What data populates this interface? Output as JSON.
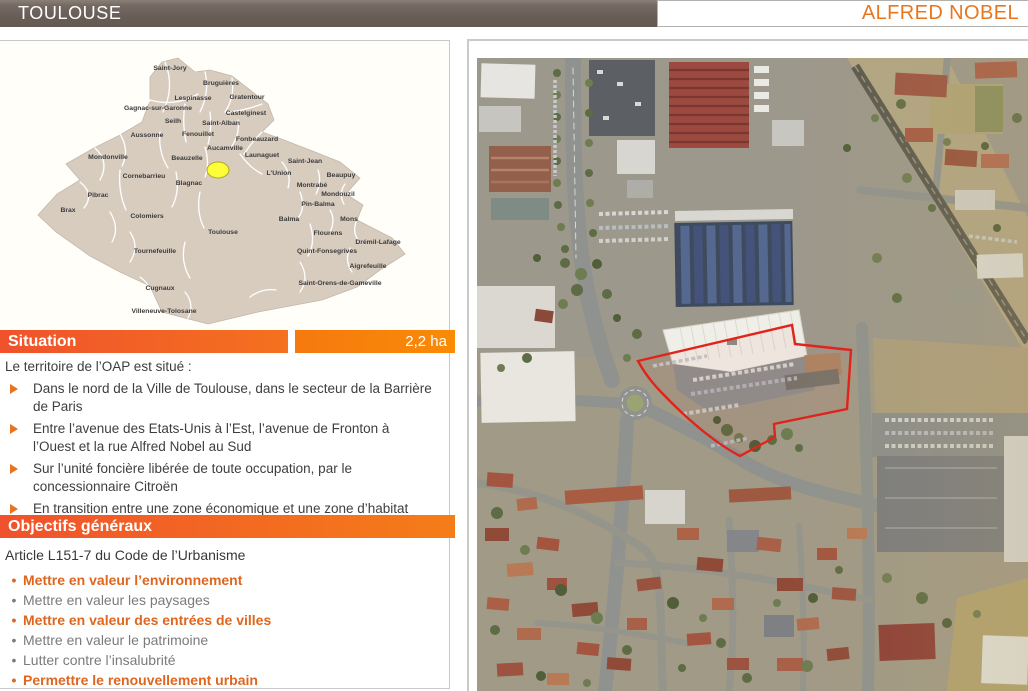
{
  "header": {
    "commune": "TOULOUSE",
    "site_name": "ALFRED NOBEL"
  },
  "situation": {
    "title": "Situation",
    "area_label": "2,2 ha",
    "intro": "Le territoire de l’OAP est situé :",
    "bullets": [
      "Dans le nord de la Ville de Toulouse, dans le secteur de la Barrière de Paris",
      "Entre l’avenue des Etats-Unis à l’Est, l’avenue de Fronton à l’Ouest et la rue Alfred Nobel au Sud",
      "Sur l’unité foncière libérée de toute occupation, par le concessionnaire Citroën",
      "En transition entre une zone économique et une zone d’habitat"
    ]
  },
  "objectifs": {
    "title": "Objectifs généraux",
    "intro": "Article L151-7 du Code de l’Urbanisme",
    "items": [
      {
        "label": "Mettre en valeur l’environnement",
        "emphasis": true
      },
      {
        "label": "Mettre en valeur les paysages",
        "emphasis": false
      },
      {
        "label": "Mettre en valeur des entrées de villes",
        "emphasis": true
      },
      {
        "label": "Mettre en valeur le patrimoine",
        "emphasis": false
      },
      {
        "label": "Lutter contre l’insalubrité",
        "emphasis": false
      },
      {
        "label": "Permettre le renouvellement urbain",
        "emphasis": true
      }
    ]
  },
  "map_panel": {
    "marker_color": "#fdfd38",
    "marker_border_color": "#a8a81e",
    "communes": [
      {
        "name": "Saint-Jory",
        "x": 170,
        "y": 28
      },
      {
        "name": "Bruguières",
        "x": 221,
        "y": 43
      },
      {
        "name": "Lespinasse",
        "x": 193,
        "y": 58
      },
      {
        "name": "Gratentour",
        "x": 247,
        "y": 57
      },
      {
        "name": "Gagnac-sur-Garonne",
        "x": 158,
        "y": 68
      },
      {
        "name": "Castelginest",
        "x": 246,
        "y": 73
      },
      {
        "name": "Seilh",
        "x": 173,
        "y": 81
      },
      {
        "name": "Saint-Alban",
        "x": 221,
        "y": 83
      },
      {
        "name": "Aussonne",
        "x": 147,
        "y": 95
      },
      {
        "name": "Fenouillet",
        "x": 198,
        "y": 94
      },
      {
        "name": "Fonbeauzard",
        "x": 257,
        "y": 99
      },
      {
        "name": "Aucamville",
        "x": 225,
        "y": 108
      },
      {
        "name": "Mondonville",
        "x": 108,
        "y": 117
      },
      {
        "name": "Beauzelle",
        "x": 187,
        "y": 118
      },
      {
        "name": "Launaguet",
        "x": 262,
        "y": 115
      },
      {
        "name": "Saint-Jean",
        "x": 305,
        "y": 121
      },
      {
        "name": "Cornebarrieu",
        "x": 144,
        "y": 136
      },
      {
        "name": "L’Union",
        "x": 279,
        "y": 133
      },
      {
        "name": "Beaupuy",
        "x": 341,
        "y": 135
      },
      {
        "name": "Blagnac",
        "x": 189,
        "y": 143
      },
      {
        "name": "Montrabé",
        "x": 312,
        "y": 145
      },
      {
        "name": "Mondouzil",
        "x": 338,
        "y": 154
      },
      {
        "name": "Pibrac",
        "x": 98,
        "y": 155
      },
      {
        "name": "Pin-Balma",
        "x": 318,
        "y": 164
      },
      {
        "name": "Brax",
        "x": 68,
        "y": 170
      },
      {
        "name": "Colomiers",
        "x": 147,
        "y": 176
      },
      {
        "name": "Balma",
        "x": 289,
        "y": 179
      },
      {
        "name": "Mons",
        "x": 349,
        "y": 179
      },
      {
        "name": "Toulouse",
        "x": 223,
        "y": 192,
        "s": 8
      },
      {
        "name": "Flourens",
        "x": 328,
        "y": 193
      },
      {
        "name": "Drémil-Lafage",
        "x": 378,
        "y": 202
      },
      {
        "name": "Tournefeuille",
        "x": 155,
        "y": 211
      },
      {
        "name": "Quint-Fonsegrives",
        "x": 327,
        "y": 211
      },
      {
        "name": "Aigrefeuille",
        "x": 368,
        "y": 226
      },
      {
        "name": "Saint-Orens-de-Gameville",
        "x": 340,
        "y": 243
      },
      {
        "name": "Cugnaux",
        "x": 160,
        "y": 248
      },
      {
        "name": "Villeneuve-Tolosane",
        "x": 164,
        "y": 271
      }
    ]
  },
  "aerial": {
    "site_outline_color": "#e0241b"
  },
  "colors": {
    "accent_orange": "#ee6b21",
    "header_brown": "#6d625b",
    "map_fill": "#d8ccbf"
  }
}
